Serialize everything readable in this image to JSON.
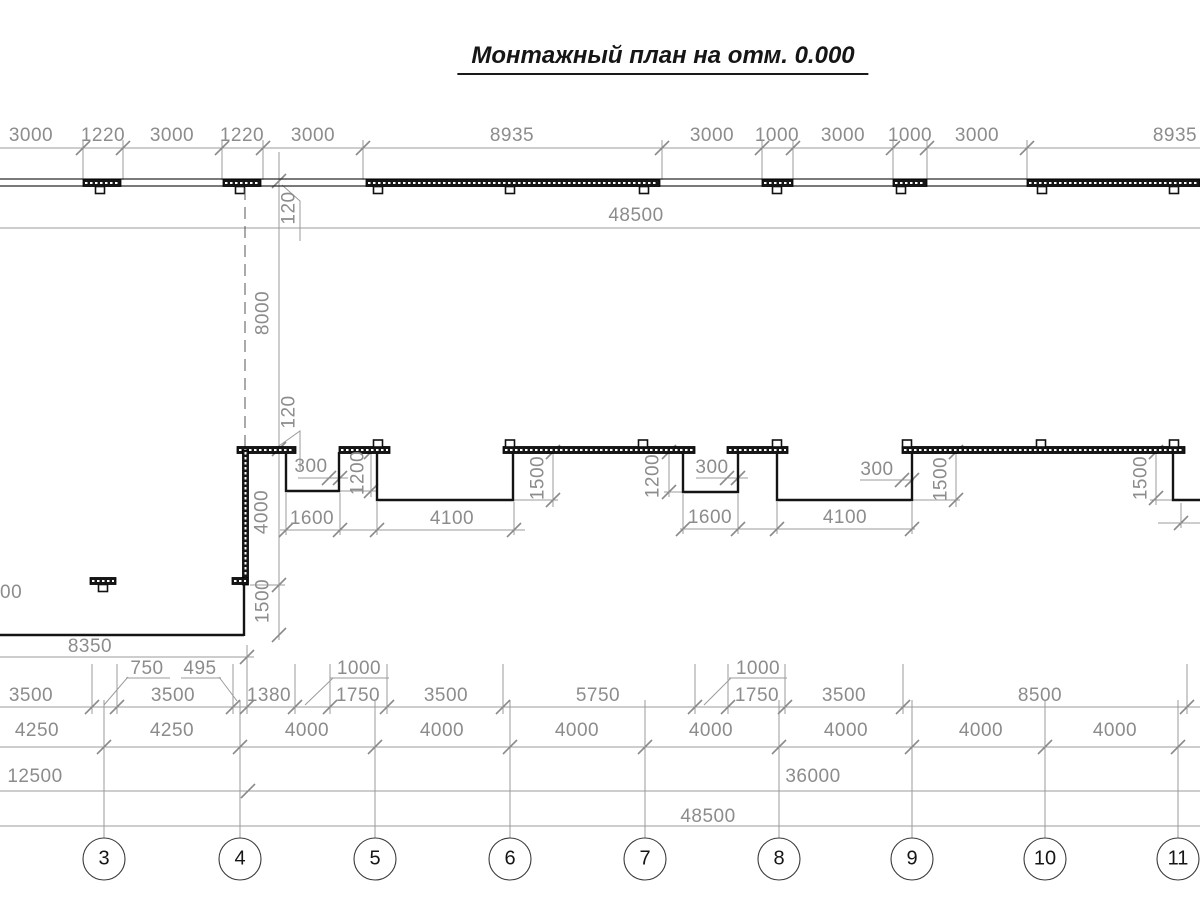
{
  "title": "Монтажный план на отм. 0.000",
  "dims": {
    "top_chain": [
      "3000",
      "1220",
      "3000",
      "1220",
      "3000",
      "8935",
      "3000",
      "1000",
      "3000",
      "1000",
      "3000",
      "8935"
    ],
    "overall_top": "48500",
    "overall_bottom": "48500",
    "vertical": {
      "wall_offset_upper": "120",
      "bay_depth": "8000",
      "wall_offset_mid": "120",
      "left_wall": "4000",
      "left_wall_lower": "1500"
    },
    "mid_chain": {
      "a300_1": "300",
      "a1200_1": "1200",
      "a1600_1": "1600",
      "a4100_1": "4100",
      "a1500_1": "1500",
      "a1200_2": "1200",
      "a300_2": "300",
      "a1600_2": "1600",
      "a300_3": "300",
      "a4100_2": "4100",
      "a1500_2": "1500",
      "a1500_3": "1500"
    },
    "left_cut": "00",
    "left_overall": "8350",
    "row1": [
      "3500",
      "3500",
      "1380",
      "1750",
      "3500",
      "5750",
      "1750",
      "3500",
      "8500"
    ],
    "row1_upper": [
      "750",
      "495",
      "1000",
      "1000"
    ],
    "row2": [
      "4250",
      "4250",
      "4000",
      "4000",
      "4000",
      "4000",
      "4000",
      "4000",
      "4000"
    ],
    "row3": [
      "12500",
      "36000"
    ]
  },
  "grid": {
    "bubbles": [
      "3",
      "4",
      "5",
      "6",
      "7",
      "8",
      "9",
      "10",
      "11"
    ]
  },
  "colors": {
    "wall": "#141414",
    "dim_text": "#8c8c8c",
    "dim_line": "#9b9b9b",
    "axis_dashed": "#555555"
  }
}
